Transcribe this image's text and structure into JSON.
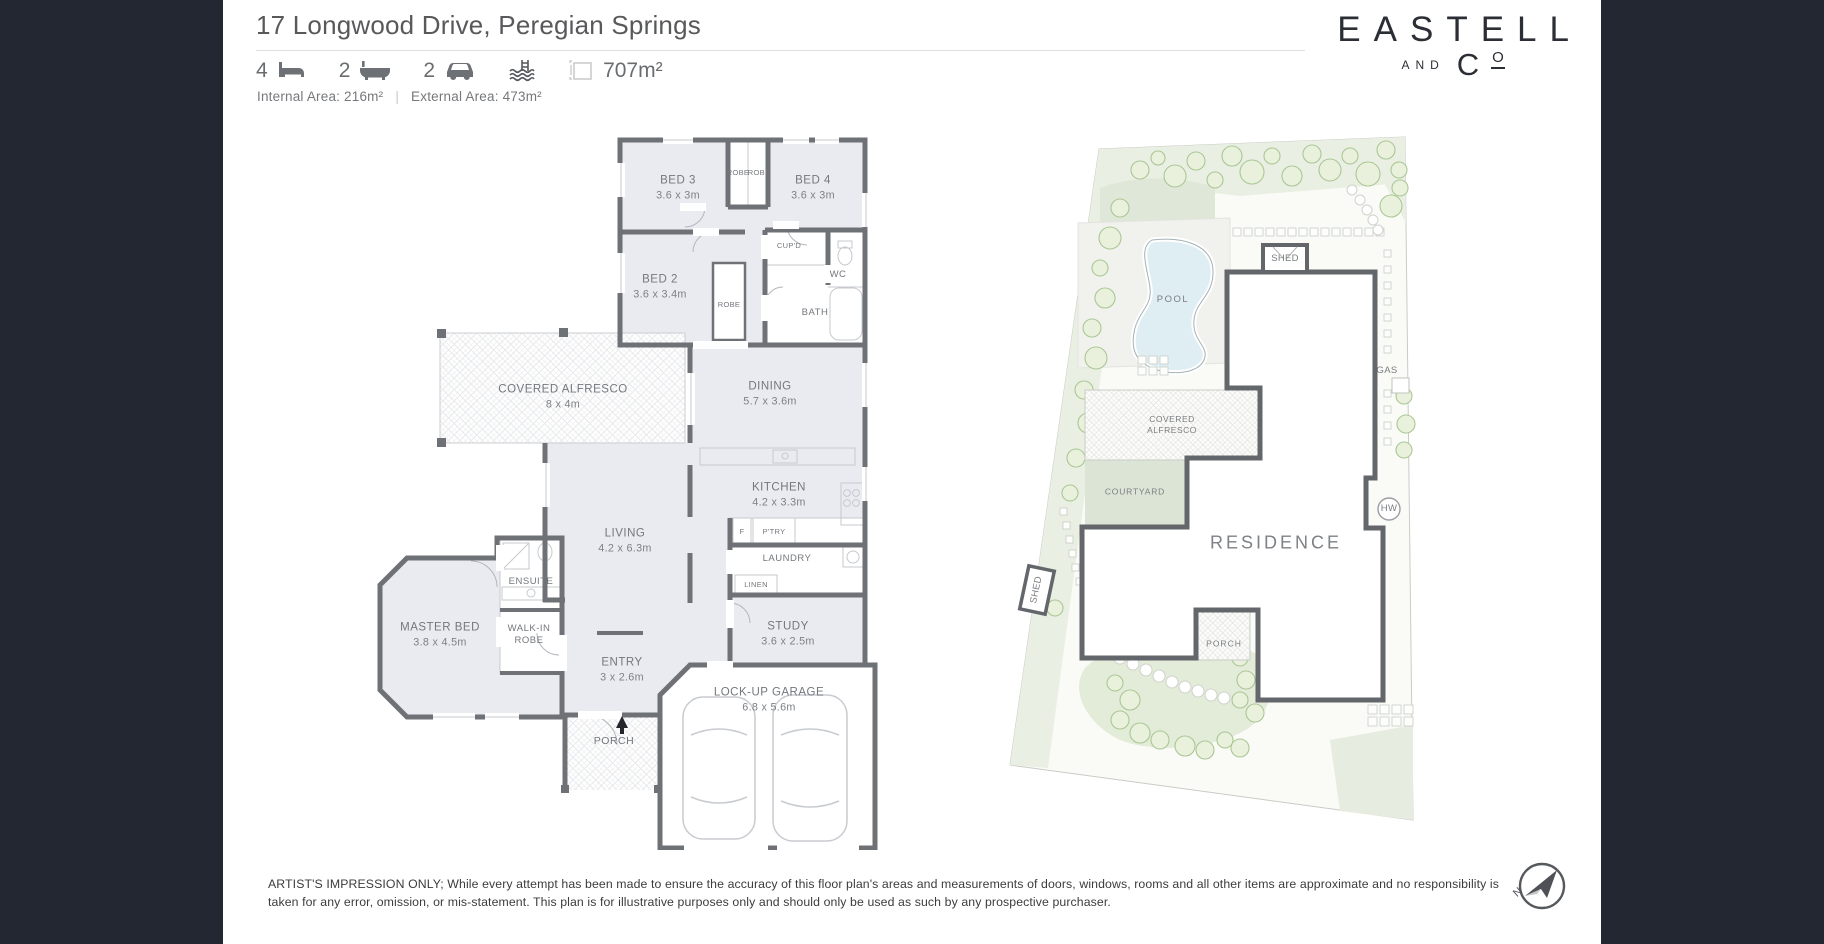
{
  "header": {
    "title": "17 Longwood Drive, Peregian Springs",
    "beds": "4",
    "baths": "2",
    "cars": "2",
    "land_area": "707m²",
    "internal_area": "Internal Area: 216m²",
    "separator": "|",
    "external_area": "External Area: 473m²"
  },
  "brand": {
    "name": "EASTELL",
    "and": "AND",
    "co_c": "C",
    "co_o": "O"
  },
  "floorplan": {
    "rooms": {
      "bed3": {
        "name": "BED 3",
        "dims": "3.6 x 3m"
      },
      "bed4": {
        "name": "BED 4",
        "dims": "3.6 x 3m"
      },
      "bed2": {
        "name": "BED 2",
        "dims": "3.6 x 3.4m"
      },
      "alfresco": {
        "name": "COVERED ALFRESCO",
        "dims": "8 x 4m"
      },
      "dining": {
        "name": "DINING",
        "dims": "5.7 x 3.6m"
      },
      "kitchen": {
        "name": "KITCHEN",
        "dims": "4.2 x 3.3m"
      },
      "living": {
        "name": "LIVING",
        "dims": "4.2 x 6.3m"
      },
      "master": {
        "name": "MASTER BED",
        "dims": "3.8 x 4.5m"
      },
      "entry": {
        "name": "ENTRY",
        "dims": "3 x 2.6m"
      },
      "study": {
        "name": "STUDY",
        "dims": "3.6 x 2.5m"
      },
      "garage": {
        "name": "LOCK-UP GARAGE",
        "dims": "6.8 x 5.6m"
      }
    },
    "labels": {
      "robe_left": "ROBE",
      "robe_right": "ROBE",
      "robe_bed2": "ROBE",
      "cupboard": "CUP'D",
      "wc": "WC",
      "bath": "BATH",
      "ensuite": "ENSUITE",
      "walk_in_robe": "WALK-IN ROBE",
      "laundry": "LAUNDRY",
      "linen": "LINEN",
      "fridge": "F",
      "pantry": "P'TRY",
      "porch": "PORCH"
    }
  },
  "siteplan": {
    "labels": {
      "pool": "POOL",
      "shed_top": "SHED",
      "gas": "GAS",
      "covered_alfresco": "COVERED ALFRESCO",
      "courtyard": "COURTYARD",
      "residence": "RESIDENCE",
      "hw": "HW",
      "shed_side": "SHED",
      "porch": "PORCH"
    }
  },
  "disclaimer": "ARTIST'S IMPRESSION ONLY; While every attempt has been made to ensure the accuracy of this floor plan's areas and measurements of doors, windows, rooms and all other items are approximate and no responsibility is taken for any error, omission, or mis-statement. This plan is for illustrative purposes only and should only be used as such by any prospective purchaser.",
  "compass": {
    "north": "N"
  },
  "colors": {
    "page_bg": "#222732",
    "wall": "#6e7175",
    "room_fill": "#e9ebf1",
    "courtyard_green": "#dce4d5",
    "lawn_green": "#e3ebd9",
    "pool_blue": "#dfeef2"
  }
}
